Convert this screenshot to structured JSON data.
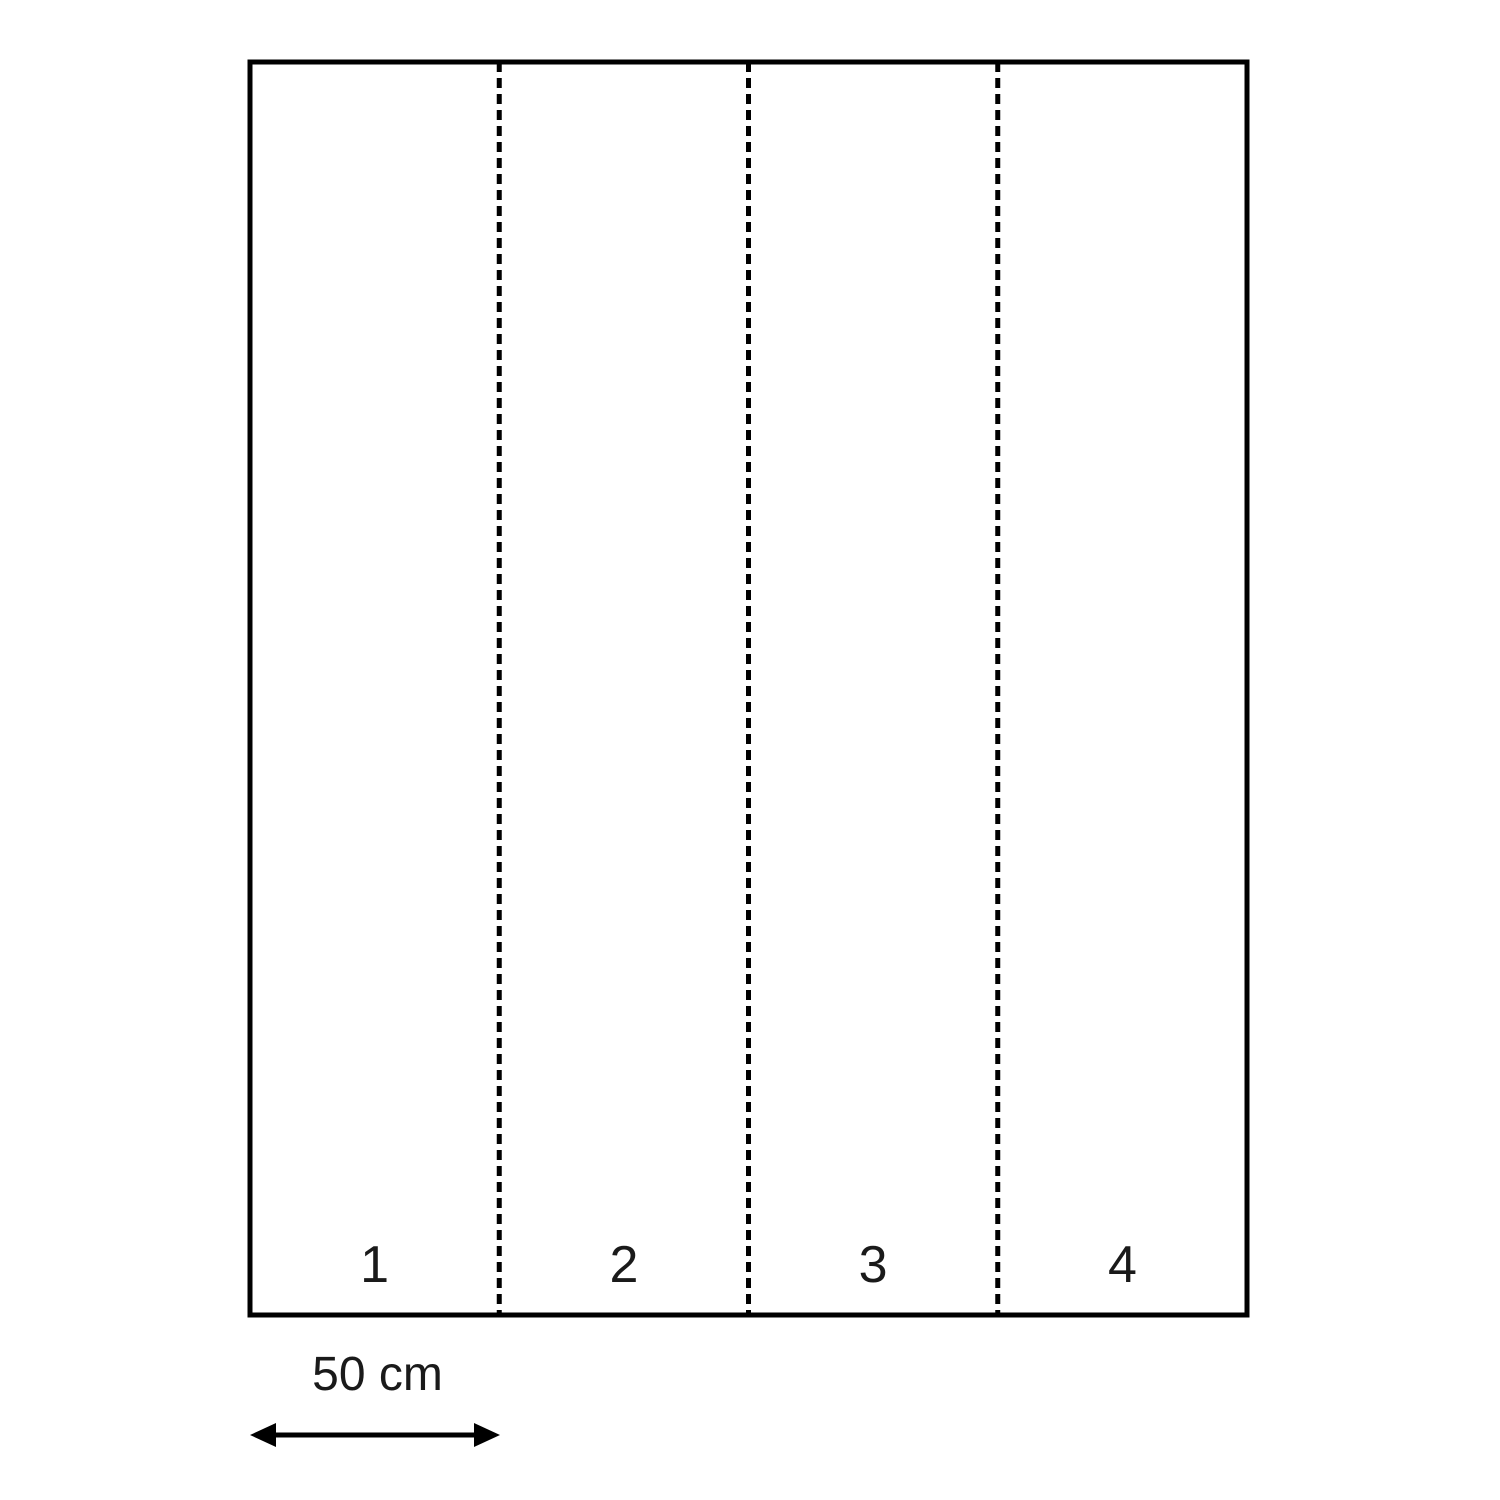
{
  "figure": {
    "title": "",
    "description": "Rectangle divided into 4 equal vertical strips by dashed fold lines, with a 50 cm scale arrow under the first strip",
    "strip_labels": [
      "1",
      "2",
      "3",
      "4"
    ],
    "scale_label": "50 cm",
    "strip_count": 4,
    "strip_width_value": "50 cm",
    "colors": {
      "stroke": "#000000",
      "text": "#1a1a1a",
      "background": "#ffffff"
    }
  }
}
